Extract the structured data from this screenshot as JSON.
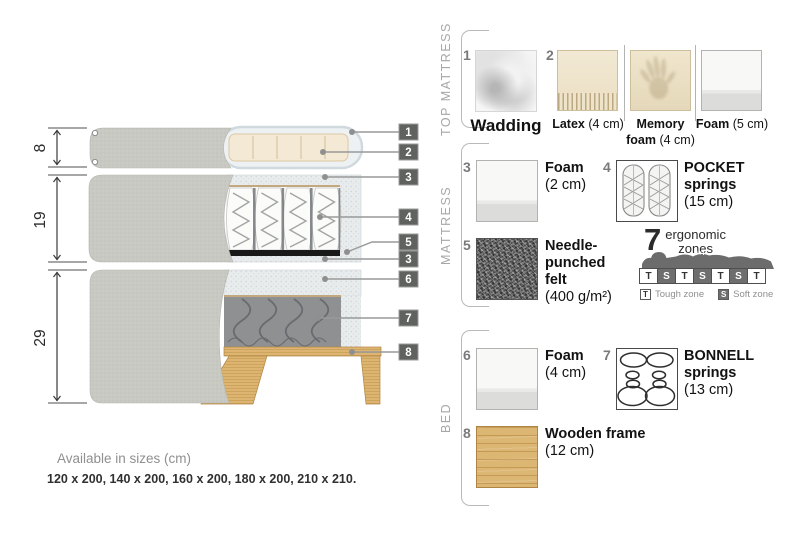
{
  "diagram": {
    "dims": [
      {
        "label": "8"
      },
      {
        "label": "19"
      },
      {
        "label": "29"
      }
    ],
    "tags": [
      "1",
      "2",
      "3",
      "4",
      "5",
      "3",
      "6",
      "7",
      "8"
    ]
  },
  "panel": {
    "sections": [
      {
        "label": "TOP MATTRESS",
        "items": [
          {
            "num": "1",
            "name": "Wadding",
            "detail": ""
          },
          {
            "num": "2",
            "name": "Latex",
            "detail": "(4 cm)"
          },
          {
            "num": "",
            "name": "Memory foam",
            "detail": "(4 cm)"
          },
          {
            "num": "",
            "name": "Foam",
            "detail": "(5 cm)"
          }
        ]
      },
      {
        "label": "MATTRESS",
        "items": [
          {
            "num": "3",
            "name": "Foam",
            "detail": "(2 cm)"
          },
          {
            "num": "4",
            "name": "POCKET springs",
            "detail": "(15 cm)"
          },
          {
            "num": "5",
            "name": "Needle-punched felt",
            "detail": "(400 g/m²)"
          }
        ],
        "ergonomic": {
          "number": "7",
          "label_line1": "ergonomic",
          "label_line2": "zones",
          "zones": [
            "T",
            "S",
            "T",
            "S",
            "T",
            "S",
            "T"
          ],
          "legend": [
            {
              "key": "T",
              "label": "Tough zone"
            },
            {
              "key": "S",
              "label": "Soft zone"
            }
          ]
        }
      },
      {
        "label": "BED",
        "items": [
          {
            "num": "6",
            "name": "Foam",
            "detail": "(4 cm)"
          },
          {
            "num": "7",
            "name": "BONNELL springs",
            "detail": "(13 cm)"
          },
          {
            "num": "8",
            "name": "Wooden frame",
            "detail": "(12 cm)"
          }
        ]
      }
    ]
  },
  "footer": {
    "title": "Available in sizes (cm)",
    "sizes": "120 x 200, 140 x 200, 160 x 200, 180 x 200, 210 x 210."
  },
  "colors": {
    "tag_bg": "#5f625f",
    "fabric_gray": "#c8c9c2",
    "foam_speckle": "#e8eced",
    "latex_cream": "#f4e9d4",
    "wood": "#ddb471",
    "felt_dark": "#191919",
    "zone_soft": "#6e6e6e"
  }
}
